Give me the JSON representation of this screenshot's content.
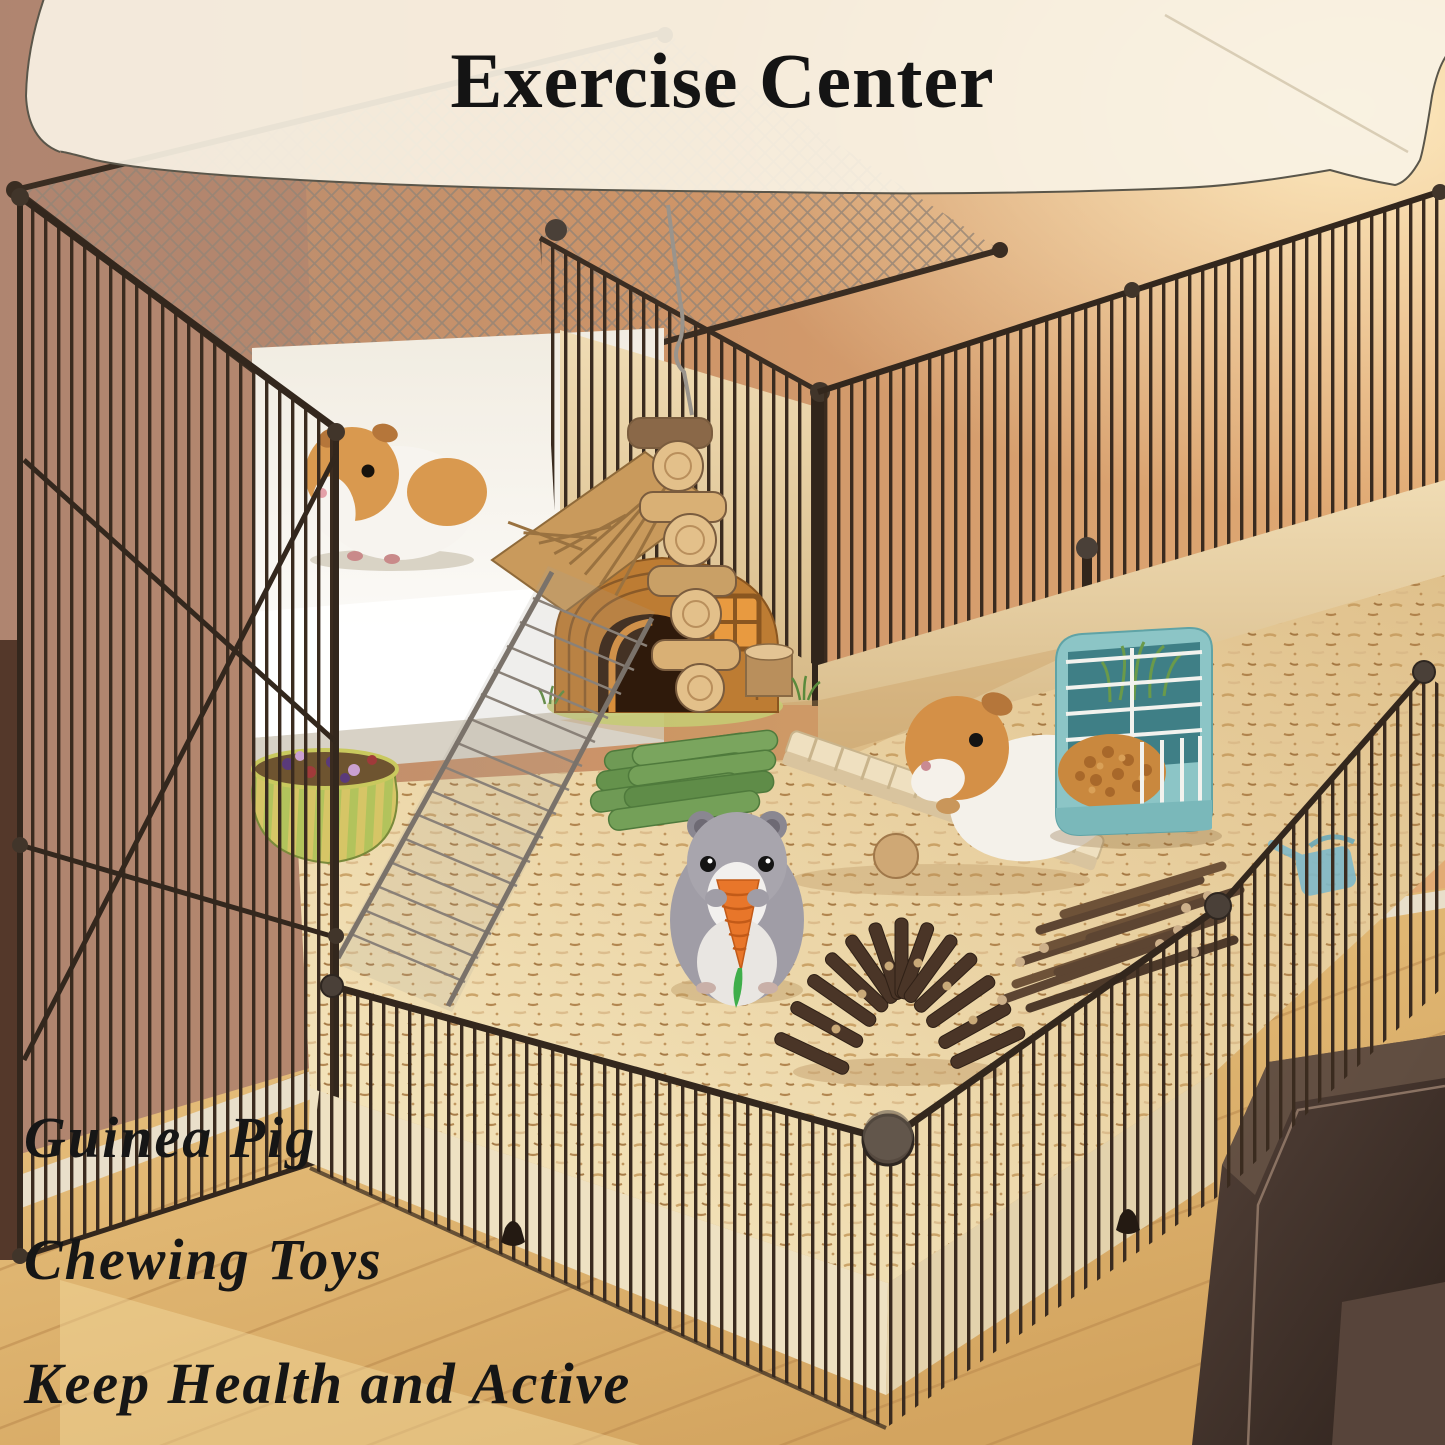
{
  "meta": {
    "kind": "product marketing photo",
    "subject": "small pet exercise playpen with guinea pigs, hamster and wooden chewing toys"
  },
  "banner": {
    "title": "Exercise Center",
    "background_color": "#f8f2e4",
    "text_color": "#141414"
  },
  "captions": {
    "line1": "Guinea Pig",
    "line2": "Chewing Toys",
    "line3": "Keep Health and Active",
    "text_color": "#161616"
  },
  "scene": {
    "objects": [
      {
        "name": "metal-playpen-cage",
        "color": "#3a2b1f"
      },
      {
        "name": "guinea-pig-upper",
        "colors": [
          "#d9994f",
          "#f7f4ef"
        ]
      },
      {
        "name": "guinea-pig-on-seesaw",
        "colors": [
          "#d49047",
          "#f4f1ea"
        ]
      },
      {
        "name": "hamster-with-carrot",
        "colors": [
          "#a09da6",
          "#f2f0ee"
        ]
      },
      {
        "name": "carrot-chew-toy",
        "colors": [
          "#e8762a",
          "#3fae4a"
        ]
      },
      {
        "name": "wooden-house",
        "color": "#bd7c33"
      },
      {
        "name": "hanging-wood-kabob-chew",
        "color": "#d9b075"
      },
      {
        "name": "wooden-seesaw",
        "color": "#efe0c0"
      },
      {
        "name": "grass-chew-sticks",
        "color": "#6f9a55"
      },
      {
        "name": "twig-arch-bridge",
        "color": "#4a3527"
      },
      {
        "name": "apple-stick-bundle",
        "color": "#5d4532"
      },
      {
        "name": "hay-feeder",
        "colors": [
          "#8cc5c6",
          "#c9883e"
        ]
      },
      {
        "name": "treat-bowl",
        "colors": [
          "#b2c35c",
          "#d6c566"
        ]
      },
      {
        "name": "wire-ramp",
        "color": "#7a726a"
      },
      {
        "name": "bedding",
        "color": "#ecd3a2"
      },
      {
        "name": "wood-floor",
        "color": "#dcb26e"
      },
      {
        "name": "leather-sofa",
        "color": "#42332b"
      }
    ]
  },
  "palette": {
    "wall_warm": "#cf9467",
    "wall_glow": "#ffe8bb",
    "wall_left": "#b78e78",
    "wire": "#3a2b1f",
    "liner_cream": "#eee1c2",
    "backdrop_white": "#ffffff"
  }
}
